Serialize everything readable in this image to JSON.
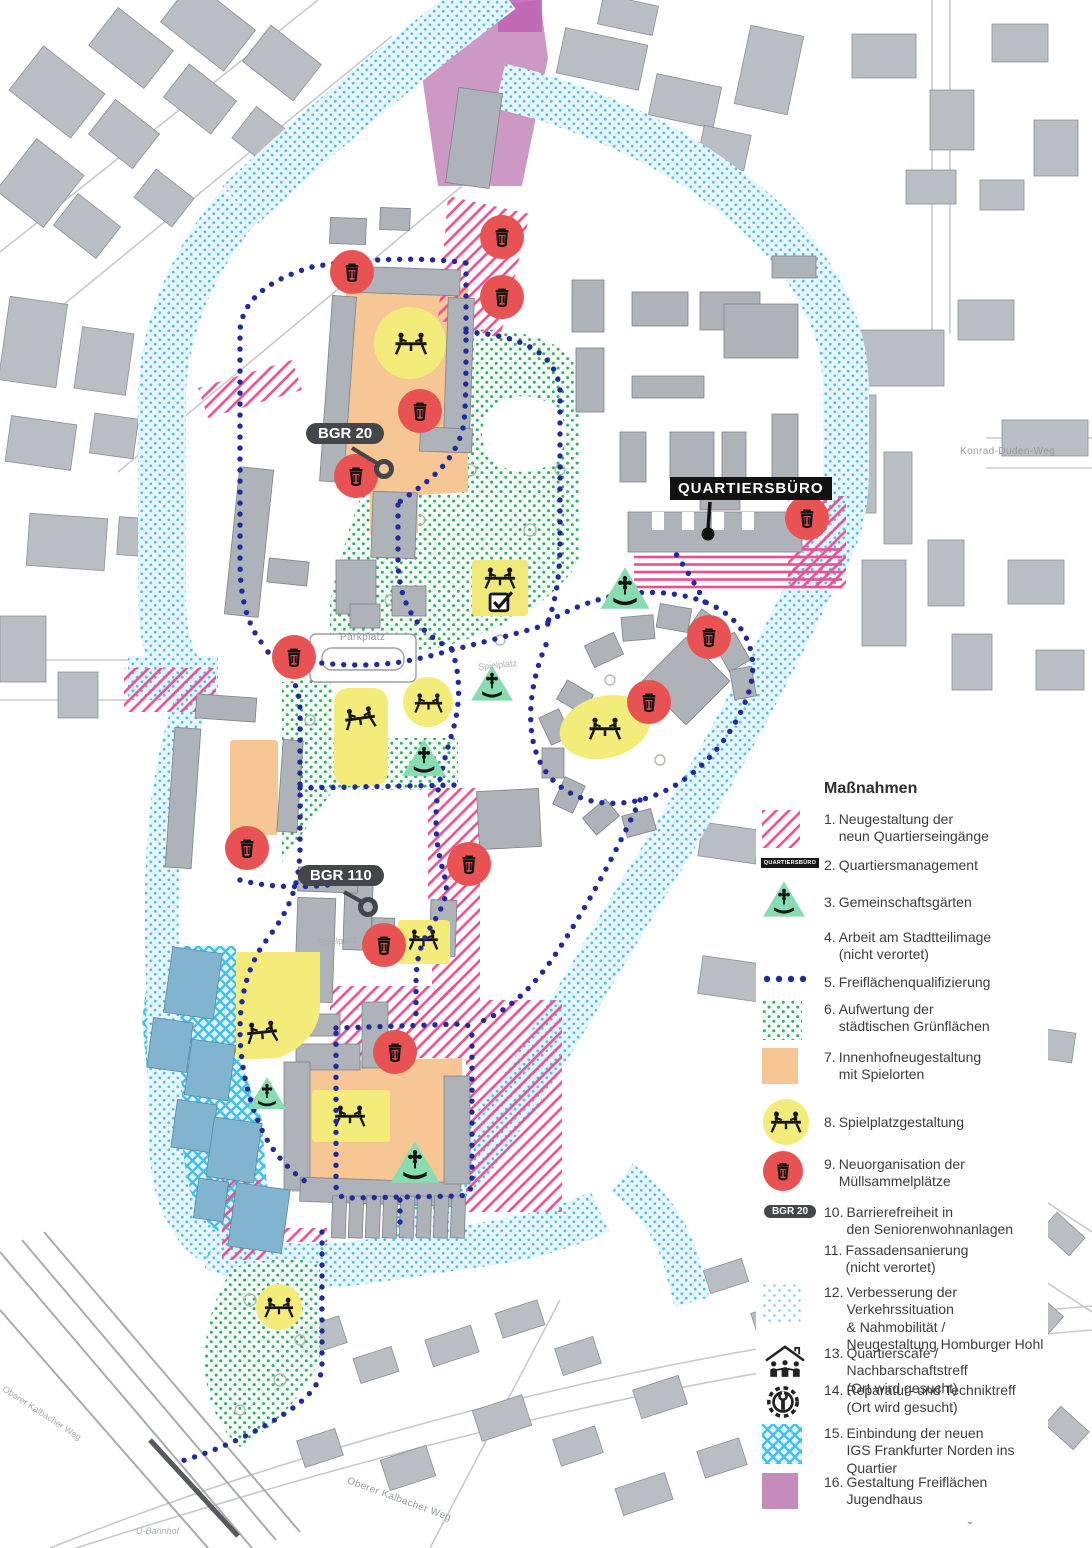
{
  "legend": {
    "title": "Maßnahmen",
    "badge_quartiersbuero": "QUARTIERSBÜRO",
    "badge_bgr": "BGR 20",
    "items": [
      {
        "num": "1.",
        "label": "Neugestaltung der\nneun Quartierseingänge"
      },
      {
        "num": "2.",
        "label": "Quartiersmanagement"
      },
      {
        "num": "3.",
        "label": "Gemeinschaftsgärten"
      },
      {
        "num": "4.",
        "label": "Arbeit am Stadtteilimage\n(nicht verortet)"
      },
      {
        "num": "5.",
        "label": "Freiflächenqualifizierung"
      },
      {
        "num": "6.",
        "label": "Aufwertung der\nstädtischen Grünflächen"
      },
      {
        "num": "7.",
        "label": "Innenhofneugestaltung\nmit Spielorten"
      },
      {
        "num": "8.",
        "label": "Spielplatzgestaltung"
      },
      {
        "num": "9.",
        "label": "Neuorganisation der\nMüllsammelplätze"
      },
      {
        "num": "10.",
        "label": "Barrierefreiheit in\nden Seniorenwohnanlagen"
      },
      {
        "num": "11.",
        "label": "Fassadensanierung\n(nicht verortet)"
      },
      {
        "num": "12.",
        "label": "Verbesserung der Verkehrssituation\n& Nahmobilität /\nNeugestaltung Homburger Hohl"
      },
      {
        "num": "13.",
        "label": "Quartierscafé / Nachbarschaftstreff\n(Ort wird gesucht)"
      },
      {
        "num": "14.",
        "label": "Reparatur- und Techniktreff\n(Ort wird gesucht)"
      },
      {
        "num": "15.",
        "label": "Einbindung der neuen\nIGS Frankfurter Norden ins Quartier"
      },
      {
        "num": "16.",
        "label": "Gestaltung Freiflächen Jugendhaus"
      }
    ]
  },
  "map": {
    "labels": {
      "quartiersbuero": "QUARTIERSBÜRO",
      "bgr20": "BGR 20",
      "bgr110": "BGR 110",
      "parkplatz": "Parkplatz",
      "spielplatz": "Spielplatz",
      "konrad_duden_weg": "Konrad-Duden-Weg",
      "oberer_kalbacher_weg": "Oberer Kalbacher Weg",
      "u_bahnhof": "U-Bahnhof"
    },
    "icons": {
      "trash-icon": "Müllsammelplatz (roter Kreis)",
      "garden-icon": "Gemeinschaftsgarten (grünes Dreieck)",
      "playground-icon": "Spielplatz (gelber Kreis, Personen)",
      "checkbox-icon": "Häkchen-Kasten",
      "cafe-icon": "Haus mit Personen",
      "repair-icon": "Zahnrad mit Werkzeug"
    }
  },
  "colors": {
    "pink": "#ec4e93",
    "cyan_dot": "#54c0e4",
    "cyan_bg": "#e8f6fc",
    "green_dot": "#2ead6d",
    "navy_dot": "#232b9b",
    "orange": "#f6c795",
    "yellow": "#f3ec7b",
    "red": "#e95253",
    "purple": "#c48bbc",
    "school_blue": "#44c0e8",
    "school_building": "#80b4cf",
    "building_gray": "#b3b7be",
    "label_dark": "#43474b"
  }
}
